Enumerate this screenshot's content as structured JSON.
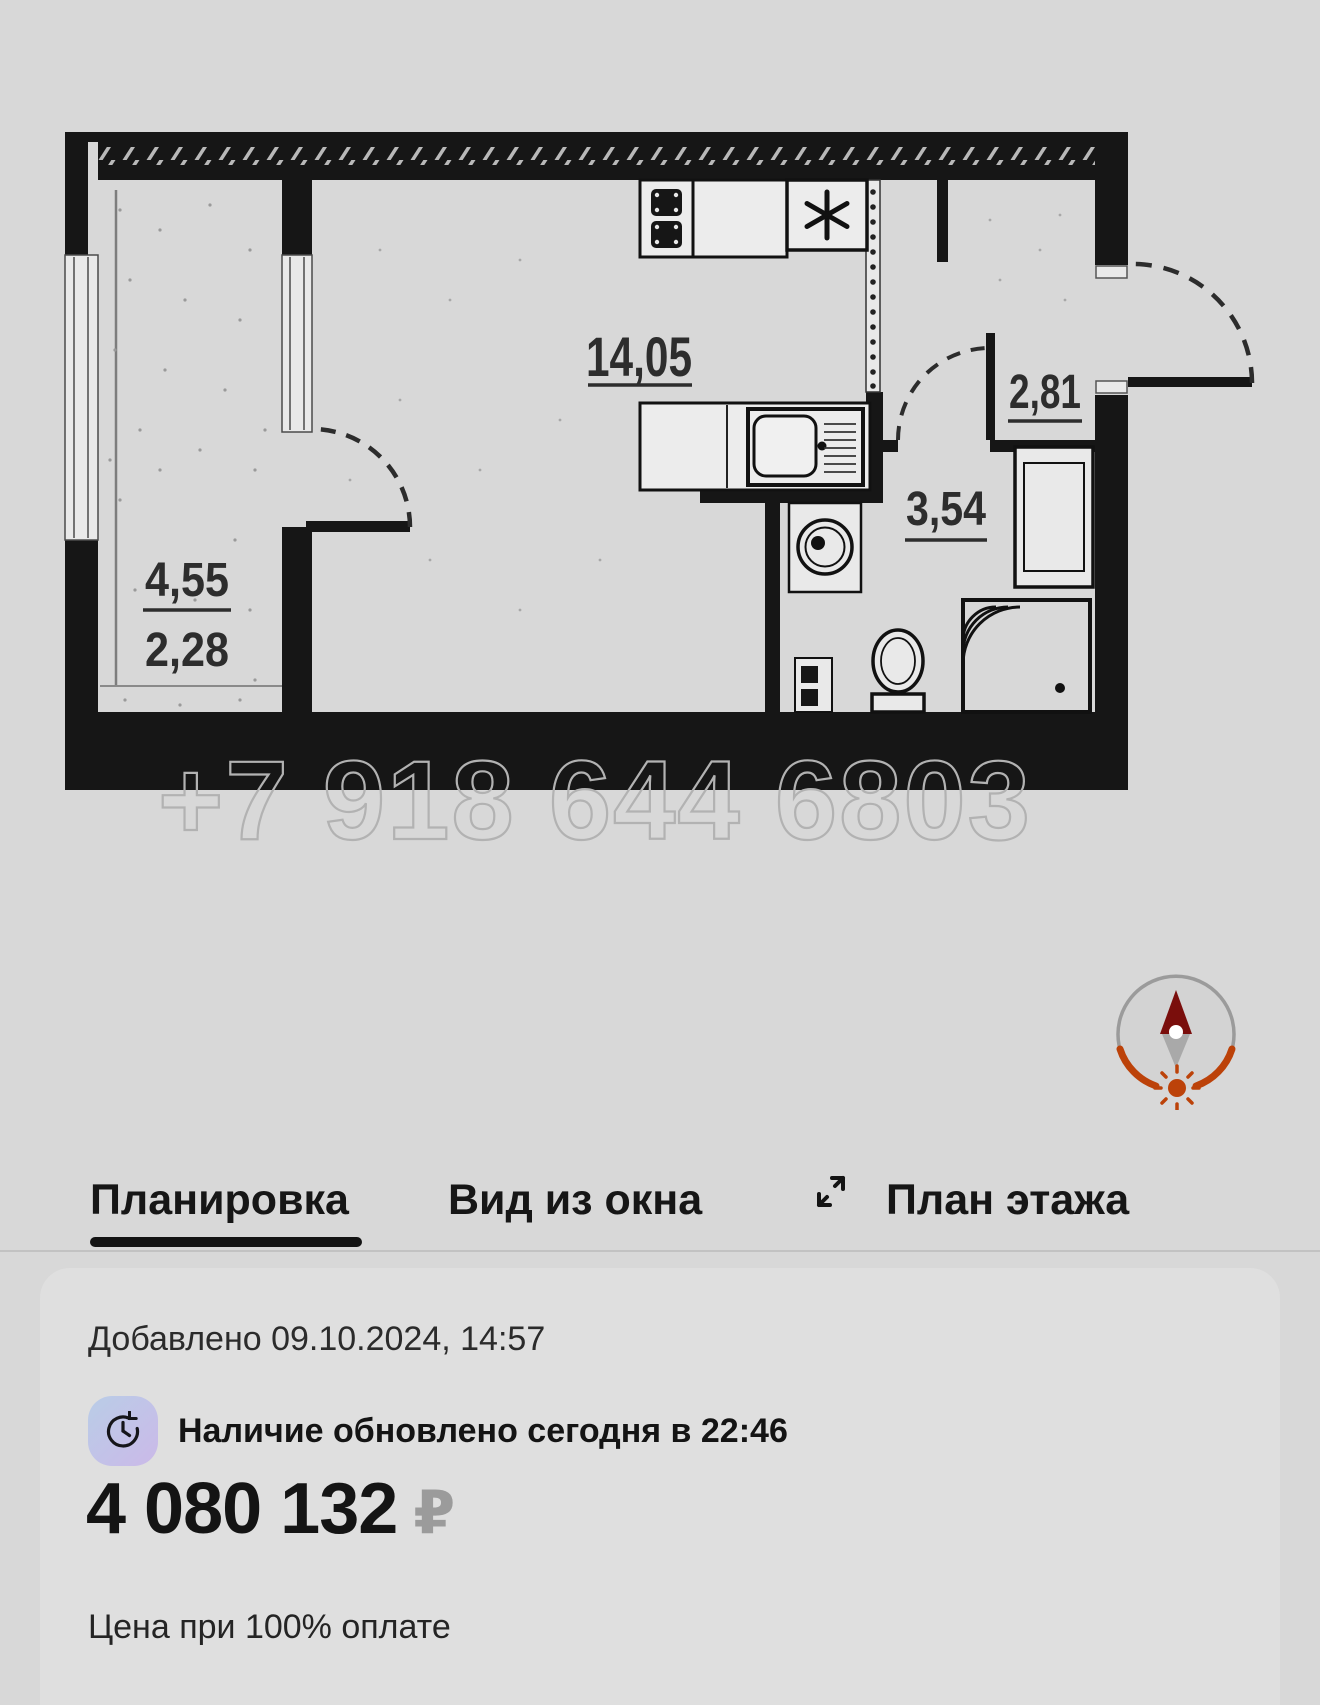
{
  "watermark": "+7 918 644 6803",
  "plan": {
    "labels": {
      "balcony_area": "4,55",
      "balcony_area_reduced": "2,28",
      "room_area": "14,05",
      "hall_area": "2,81",
      "bath_area": "3,54"
    }
  },
  "tabs": {
    "planirovka": "Планировка",
    "vid_iz_okna": "Вид из окна",
    "plan_etazha": "План этажа"
  },
  "card": {
    "added": "Добавлено 09.10.2024, 14:57",
    "availability": "Наличие обновлено сегодня в 22:46",
    "price": "4 080 132",
    "currency": "₽",
    "note": "Цена при 100% оплате"
  },
  "colors": {
    "accent_orange": "#bc4209",
    "needle_red": "#7a0e0c",
    "wall_black": "#161616",
    "clock_badge_gradient_start": "#b9cde7",
    "clock_badge_gradient_end": "#cbb9e8"
  }
}
